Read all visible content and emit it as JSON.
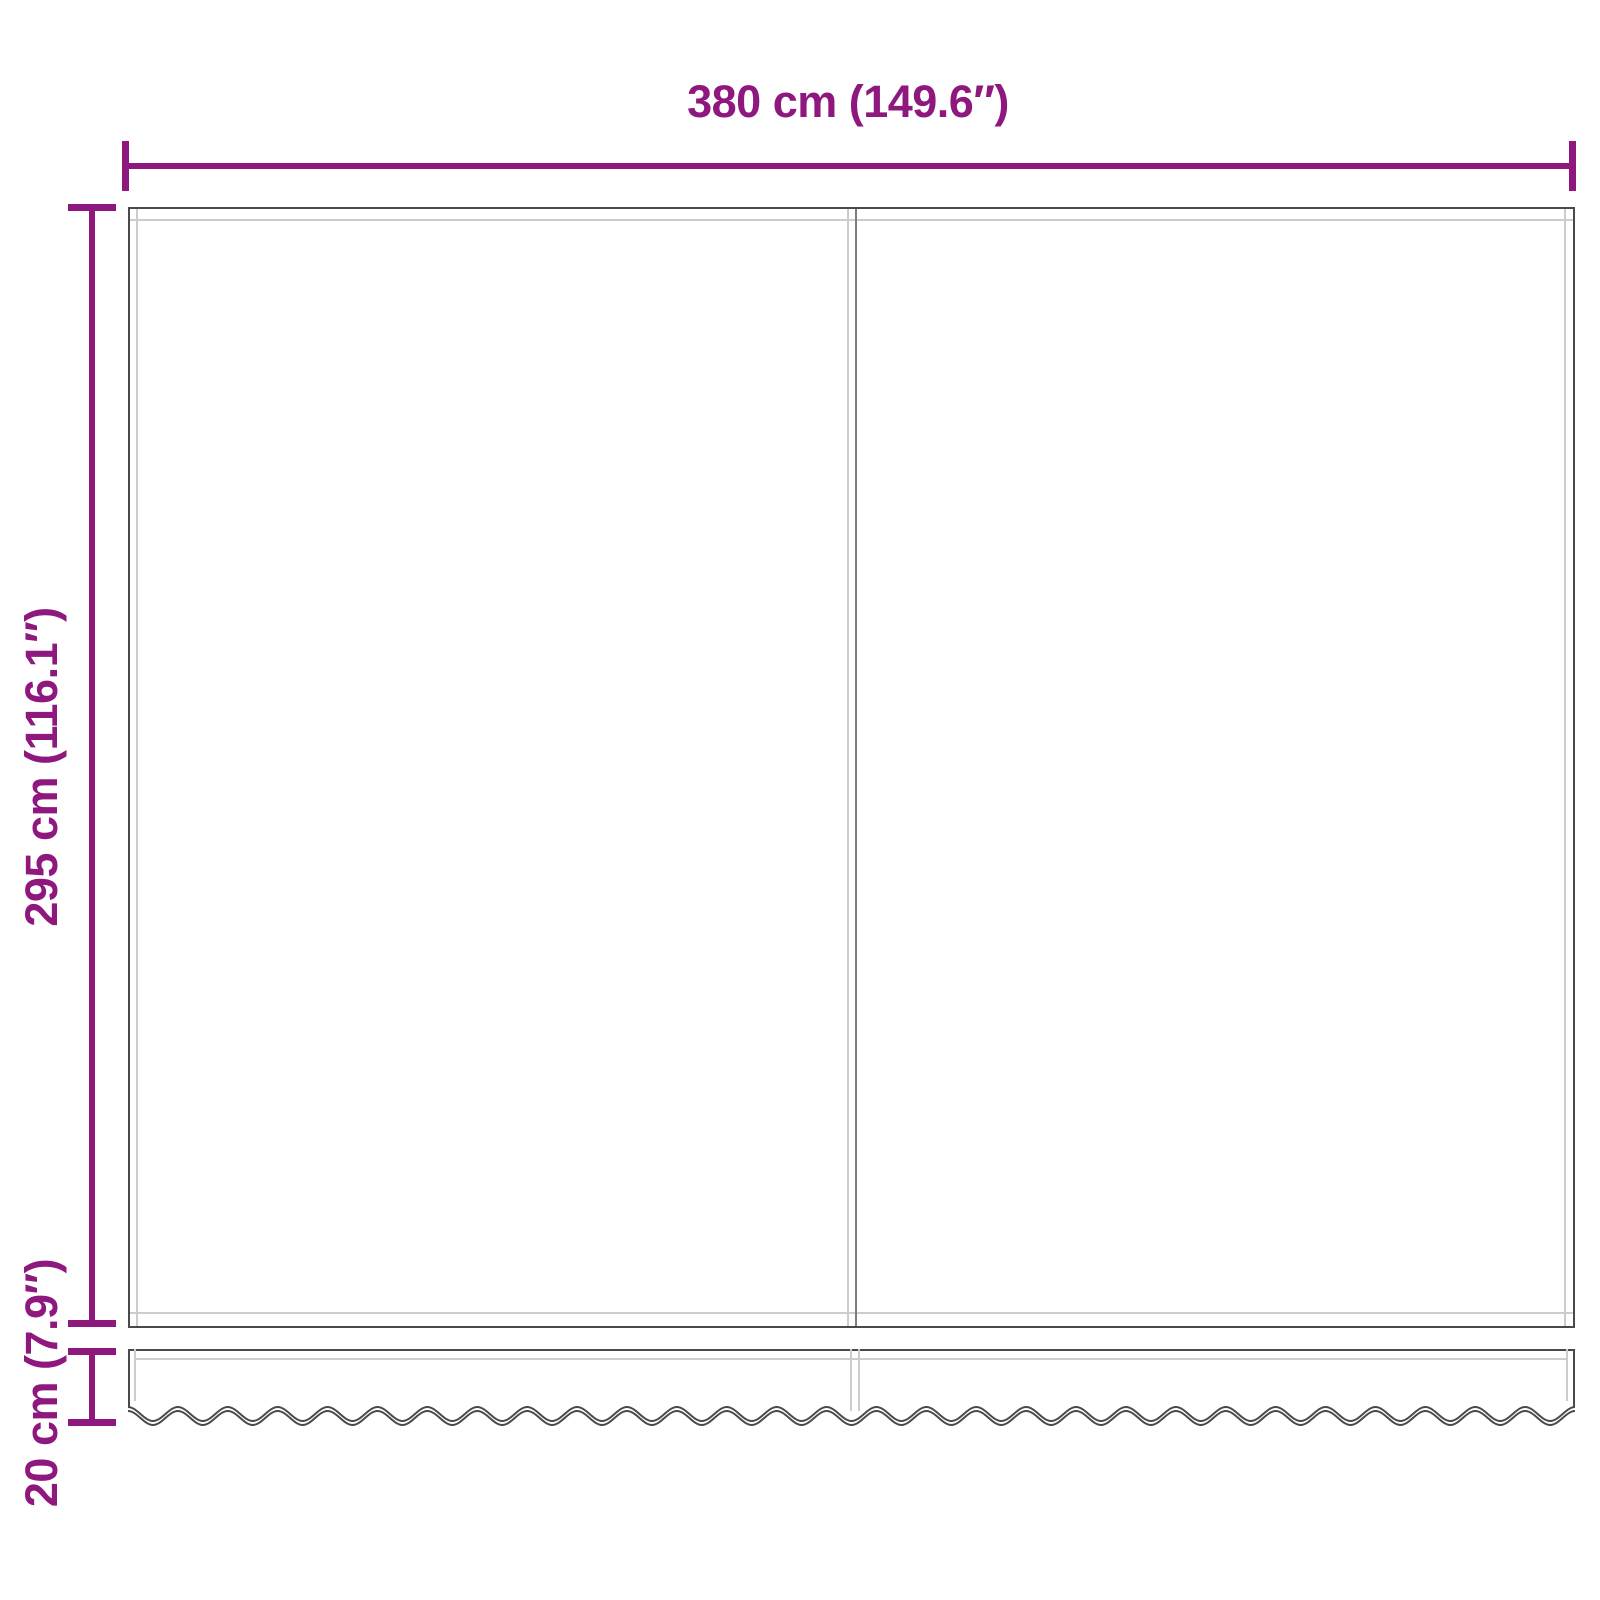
{
  "diagram": {
    "title": "awning-fabric-dimension-diagram",
    "dimensions": {
      "width": {
        "label": "380 cm (149.6″)"
      },
      "height": {
        "label": "295 cm (116.1″)"
      },
      "valance_height": {
        "label": "20 cm (7.9″)"
      }
    }
  },
  "colors": {
    "accent": "#8F187E",
    "outline": "#4A4A4A",
    "inner_line": "#CCCCCC",
    "seam": "#7D7D7D"
  }
}
